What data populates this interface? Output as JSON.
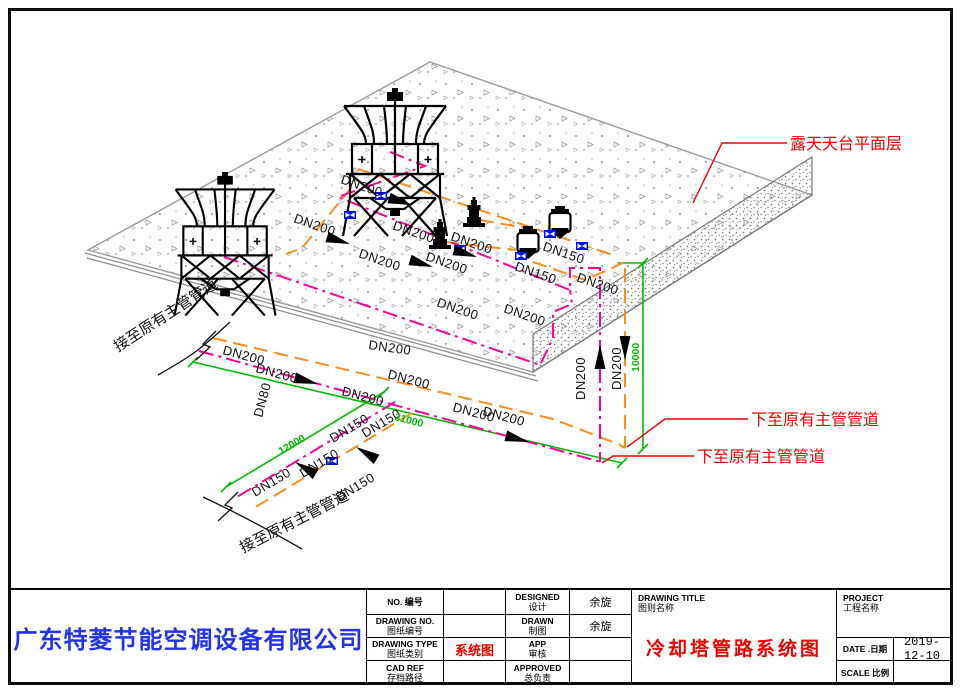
{
  "sheet": {
    "company": "广东特菱节能空调设备有限公司",
    "title_block": {
      "no_label_en": "NO.",
      "no_label_cn": "编号",
      "no_value": "",
      "drawing_no_en": "DRAWING NO.",
      "drawing_no_cn": "图纸编号",
      "drawing_no_value": "",
      "drawing_type_en": "DRAWING TYPE",
      "drawing_type_cn": "图纸类别",
      "drawing_type_value": "系统图",
      "cad_ref_en": "CAD REF",
      "cad_ref_cn": "存档路径",
      "cad_ref_value": "",
      "designed_en": "DESIGNED",
      "designed_cn": "设计",
      "designed_value": "余旋",
      "drawn_en": "DRAWN",
      "drawn_cn": "制图",
      "drawn_value": "余旋",
      "app_en": "APP",
      "app_cn": "审核",
      "app_value": "",
      "approved_en": "APPROVED",
      "approved_cn": "总负责",
      "approved_value": "",
      "drawing_title_en": "DRAWING TITLE",
      "drawing_title_cn": "图则名称",
      "drawing_title_value": "冷却塔管路系统图",
      "project_en": "PROJECT",
      "project_cn": "工程名称",
      "project_value": "",
      "date_label": "DATE .日期",
      "date_value": "2019-12-10",
      "scale_label": "SCALE 比例",
      "scale_value": ""
    }
  },
  "drawing": {
    "annotations": {
      "roof_level": "露天天台平面层",
      "down_to_main_1": "下至原有主管管道",
      "down_to_main_2": "下至原有主管管道",
      "connect_existing_upper": "接至原有主管管道",
      "connect_existing_lower": "接至原有主管管道"
    },
    "pipe_labels": {
      "dn200": "DN200",
      "dn150": "DN150",
      "dn80": "DN80"
    },
    "dimensions": {
      "run_main": "31000",
      "run_branch": "12000",
      "drop_height": "10000"
    },
    "colors": {
      "supply_orange": "#FF8C1A",
      "return_magenta": "#FF0099",
      "dimension_green": "#00BB00",
      "annotation_red": "#F00000",
      "valve_blue": "#0000EE",
      "company_blue": "#2233EE"
    }
  }
}
